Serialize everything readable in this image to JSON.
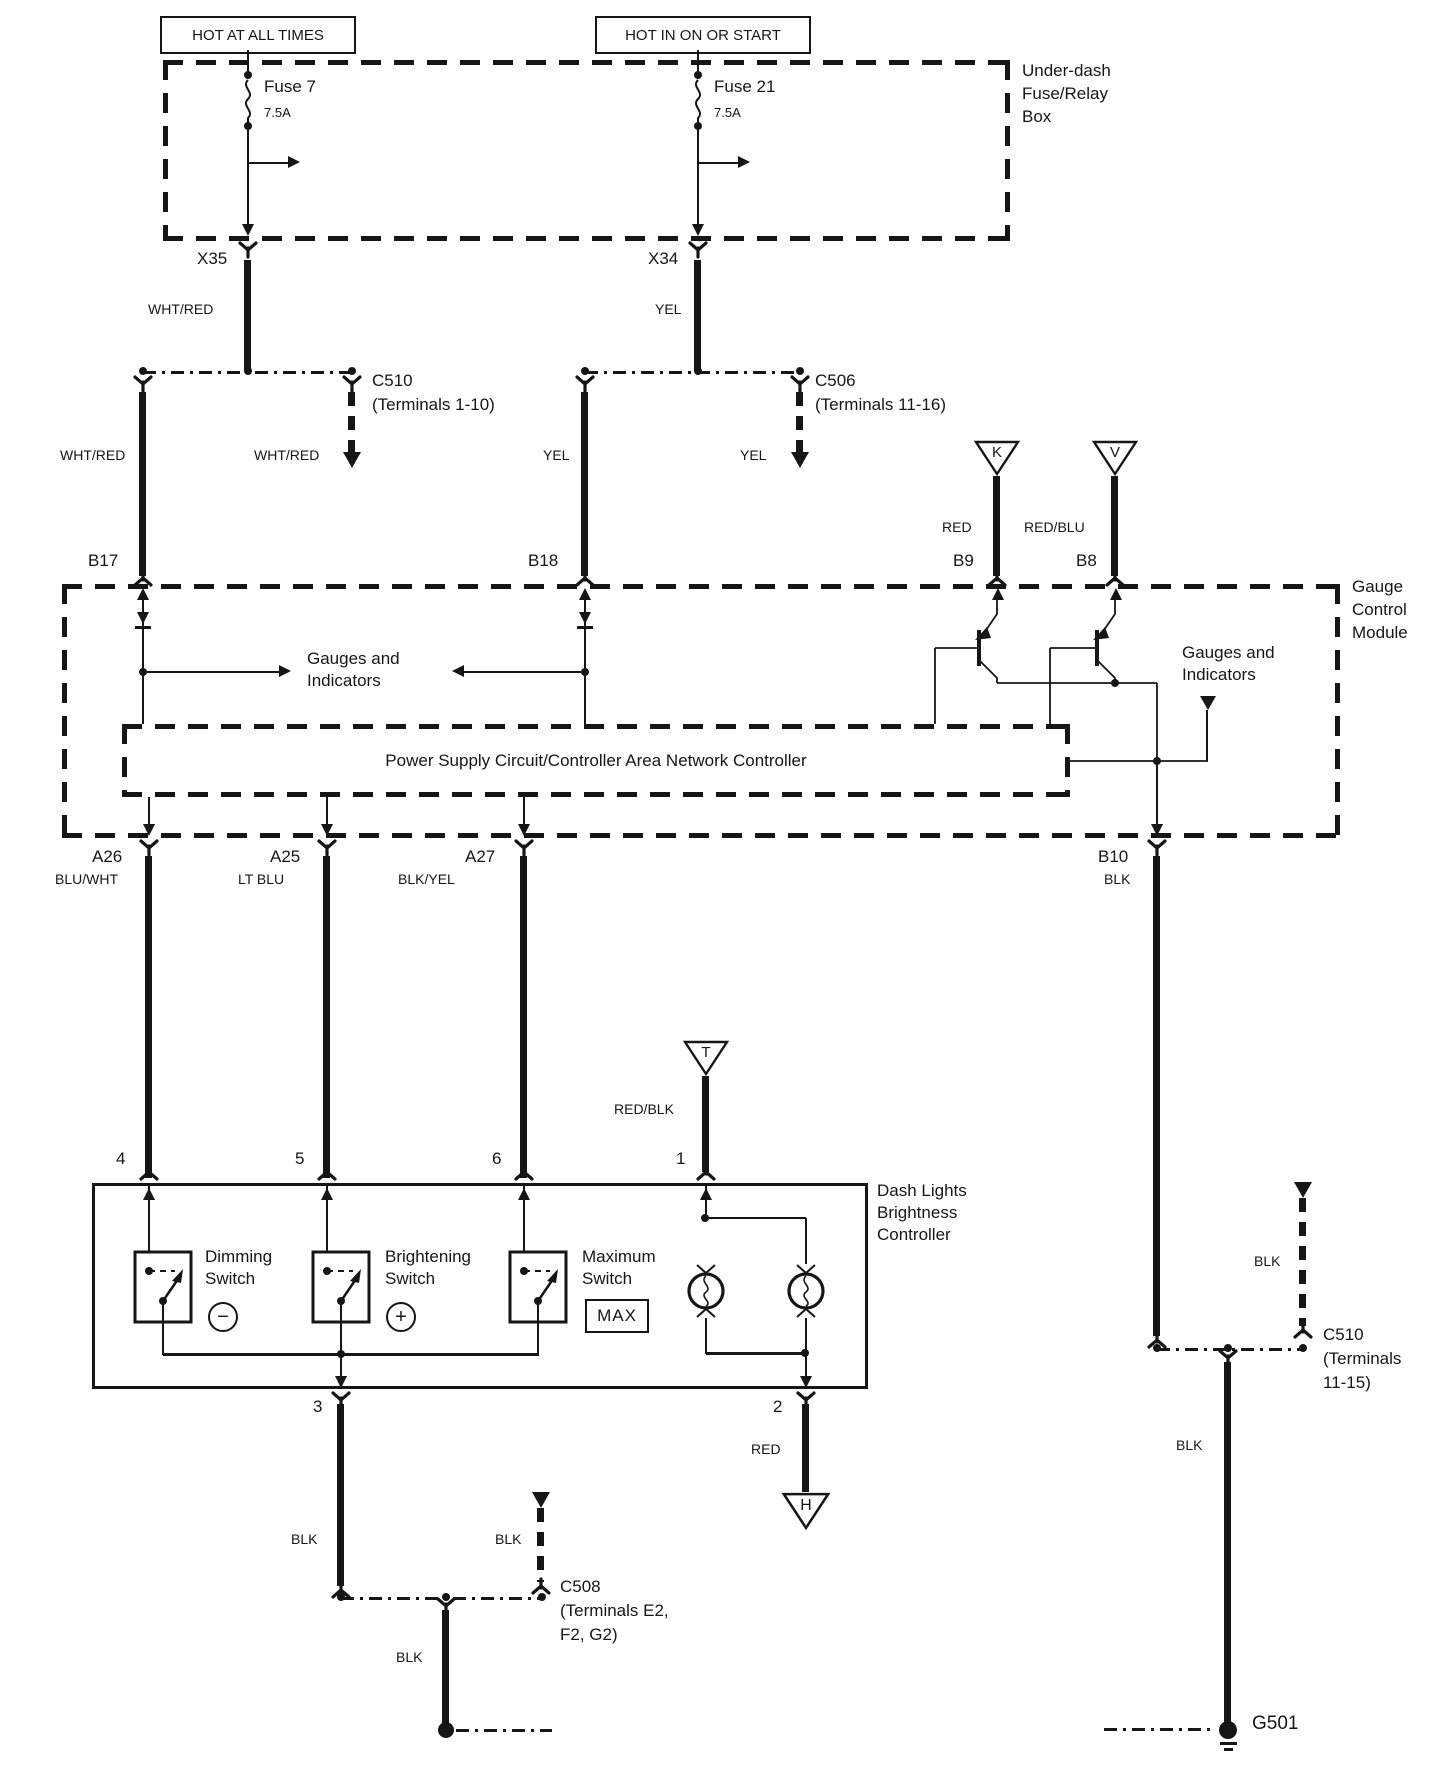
{
  "sources": {
    "left": "HOT AT ALL TIMES",
    "right": "HOT IN ON OR START"
  },
  "fuse_box": {
    "title": [
      "Under-dash",
      "Fuse/Relay",
      "Box"
    ],
    "fuse7": {
      "name": "Fuse 7",
      "rating": "7.5A"
    },
    "fuse21": {
      "name": "Fuse 21",
      "rating": "7.5A"
    }
  },
  "pins": {
    "x35": "X35",
    "x34": "X34",
    "b17": "B17",
    "b18": "B18",
    "b9": "B9",
    "b8": "B8",
    "a26": "A26",
    "a25": "A25",
    "a27": "A27",
    "b10": "B10",
    "p1": "1",
    "p2": "2",
    "p3": "3",
    "p4": "4",
    "p5": "5",
    "p6": "6"
  },
  "wires": {
    "whtred1": "WHT/RED",
    "whtred2": "WHT/RED",
    "whtred3": "WHT/RED",
    "yel1": "YEL",
    "yel2": "YEL",
    "yel3": "YEL",
    "red": "RED",
    "redblu": "RED/BLU",
    "redblk": "RED/BLK",
    "bluwht": "BLU/WHT",
    "ltblu": "LT BLU",
    "blkyel": "BLK/YEL",
    "blk_b10": "BLK",
    "blk_p3": "BLK",
    "blk_c508stub": "BLK",
    "blk_c508down": "BLK",
    "blk_c510stub": "BLK",
    "blk_c510down": "BLK",
    "red_p2": "RED"
  },
  "connectors": {
    "c510a": {
      "name": "C510",
      "terminals": "(Terminals 1-10)"
    },
    "c506": {
      "name": "C506",
      "terminals": "(Terminals 11-16)"
    },
    "c508": {
      "name": "C508",
      "terminals1": "(Terminals E2,",
      "terminals2": "F2, G2)"
    },
    "c510b": {
      "name": "C510",
      "terminals1": "(Terminals",
      "terminals2": "11-15)"
    }
  },
  "refs": {
    "k": "K",
    "v": "V",
    "t": "T",
    "h": "H"
  },
  "gauge_module": {
    "title": [
      "Gauge",
      "Control",
      "Module"
    ],
    "gauges_left": [
      "Gauges and",
      "Indicators"
    ],
    "gauges_right": [
      "Gauges and",
      "Indicators"
    ],
    "psu": "Power Supply Circuit/Controller Area Network Controller"
  },
  "controller": {
    "title": [
      "Dash Lights",
      "Brightness",
      "Controller"
    ],
    "dimming": {
      "line1": "Dimming",
      "line2": "Switch",
      "symbol": "−"
    },
    "brightening": {
      "line1": "Brightening",
      "line2": "Switch",
      "symbol": "+"
    },
    "maximum": {
      "line1": "Maximum",
      "line2": "Switch",
      "badge": "MAX"
    }
  },
  "ground": {
    "g501": "G501"
  }
}
